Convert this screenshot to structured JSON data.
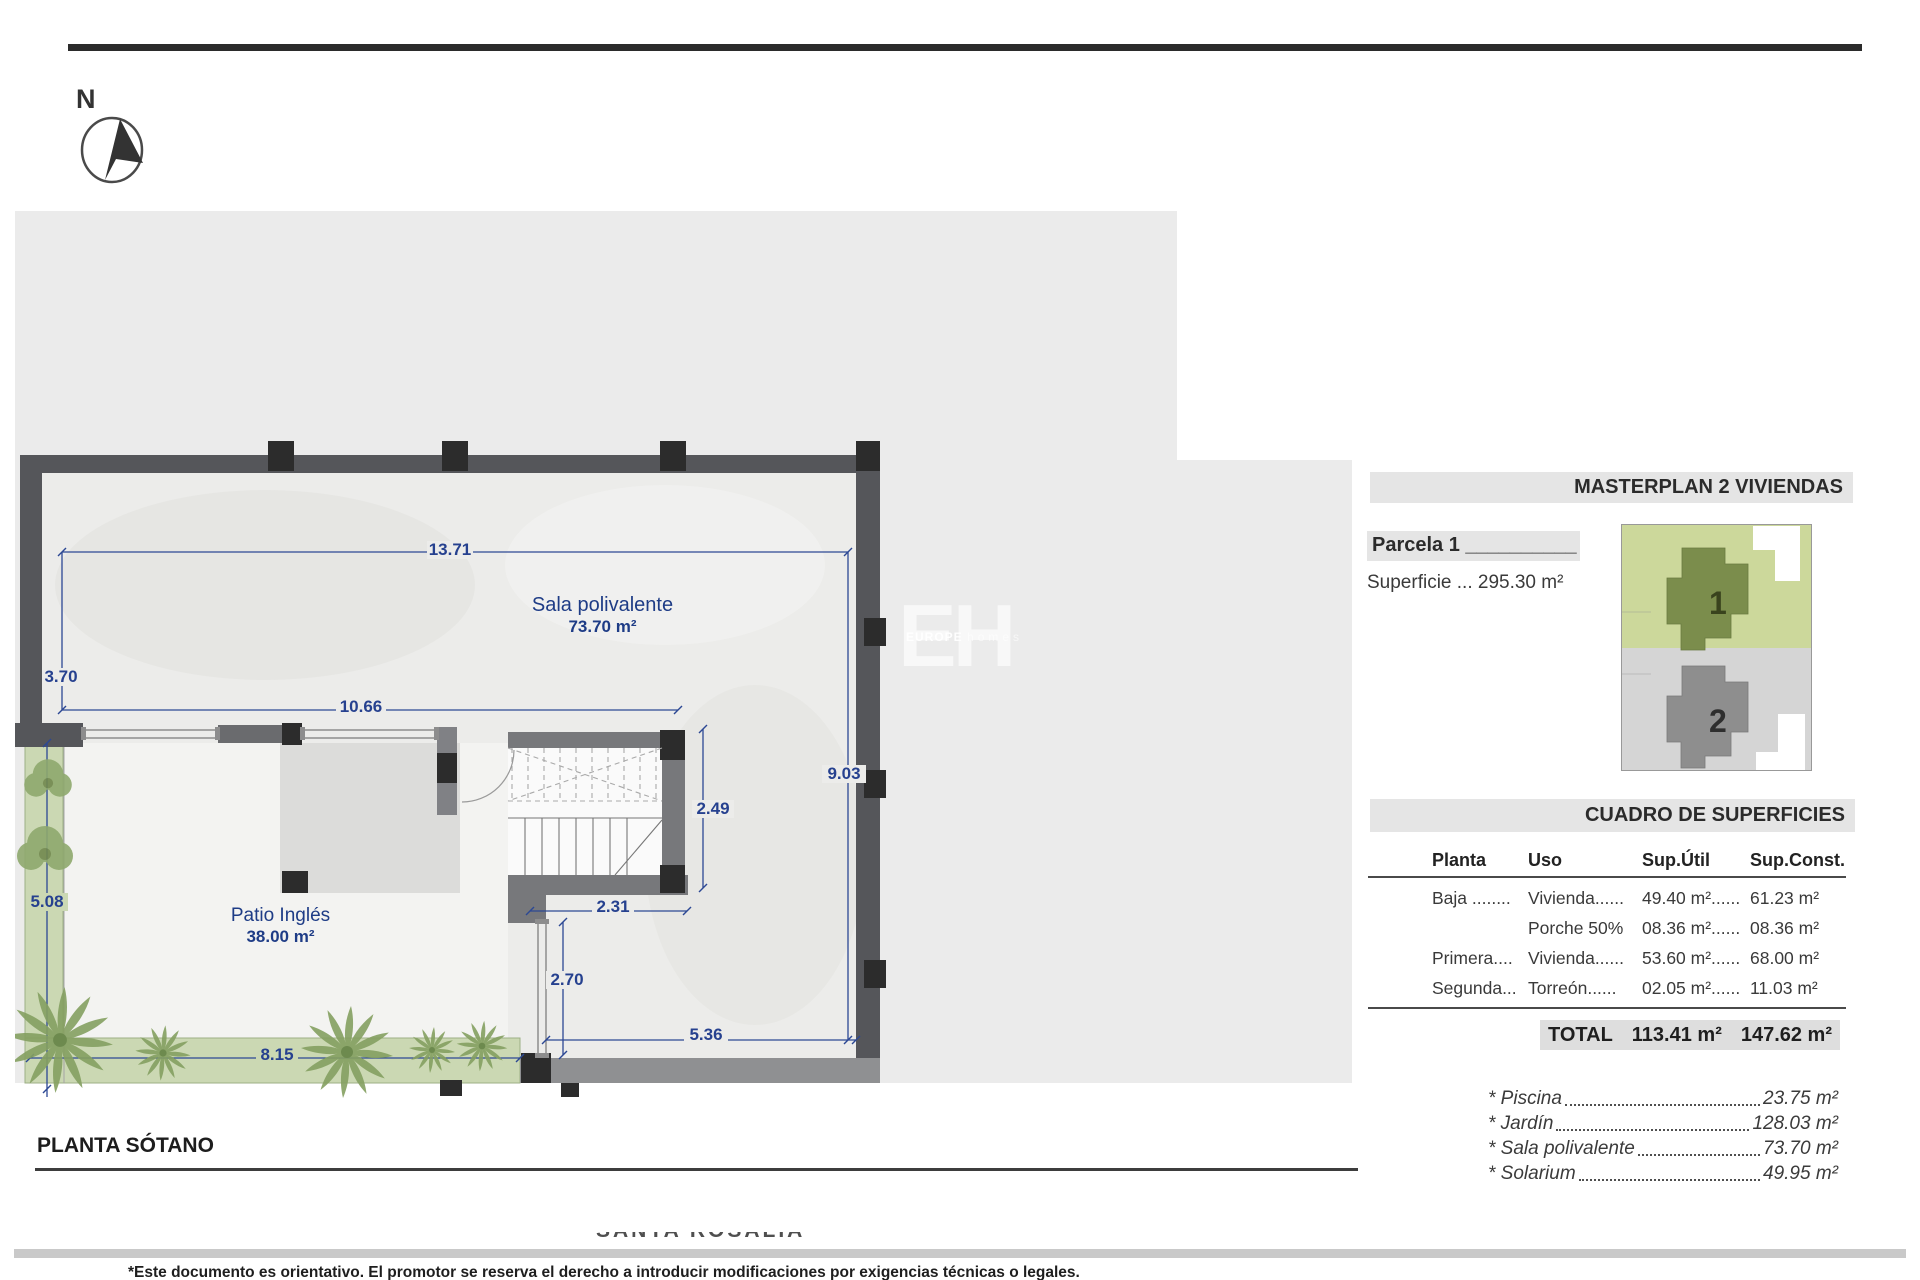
{
  "page": {
    "compass": "N",
    "plan_title": "PLANTA SÓTANO",
    "watermark_big": "EH",
    "watermark_small_bold": "EUROPE",
    "watermark_small_light": "homes",
    "watermark_clipped": "SANTA ROSALIA",
    "footer_note": "*Este documento es orientativo. El promotor se reserva el derecho a introducir modificaciones por exigencias técnicas o legales."
  },
  "plan": {
    "rooms": {
      "sala_title": "Sala polivalente",
      "sala_area": "73.70 m²",
      "patio_title": "Patio Inglés",
      "patio_area": "38.00 m²"
    },
    "dimensions": {
      "top": "13.71",
      "left": "3.70",
      "inner": "10.66",
      "right": "9.03",
      "stair_h": "2.49",
      "stair_w": "2.31",
      "door": "2.70",
      "bottom_right": "5.36",
      "bottom_left": "8.15",
      "left_lower": "5.08"
    }
  },
  "masterplan": {
    "title": "MASTERPLAN 2 VIVIENDAS",
    "parcel": "Parcela 1 __________",
    "superficie": "Superficie ... 295.30 m²",
    "plot1": "1",
    "plot2": "2"
  },
  "table": {
    "title": "CUADRO DE SUPERFICIES",
    "headers": [
      "Planta",
      "Uso",
      "Sup.Útil",
      "Sup.Const."
    ],
    "rows": [
      [
        "Baja ........",
        "Vivienda......",
        "49.40 m²......",
        "61.23 m²"
      ],
      [
        "",
        "Porche 50%",
        "08.36 m²......",
        "08.36 m²"
      ],
      [
        "Primera....",
        "Vivienda......",
        "53.60 m²......",
        "68.00 m²"
      ],
      [
        "Segunda...",
        "Torreón......",
        "02.05 m²......",
        "11.03 m²"
      ]
    ],
    "total_label": "TOTAL",
    "total_util": "113.41 m²",
    "total_const": "147.62 m²"
  },
  "extras": [
    {
      "name": "* Piscina",
      "value": "23.75 m²"
    },
    {
      "name": "* Jardín",
      "value": "128.03 m²"
    },
    {
      "name": "* Sala polivalente",
      "value": "73.70 m²"
    },
    {
      "name": "* Solarium",
      "value": "49.95 m²"
    }
  ],
  "colors": {
    "dimension_blue": "#26418f",
    "wall_gray": "#55565a",
    "backdrop_gray": "#ebebeb",
    "garden_green": "#cbd8b3",
    "plot1_bg": "#ccd89b",
    "plot1_house": "#7b8d4c",
    "plot2_bg": "#d5d5d5",
    "plot2_house": "#8e8e8e"
  }
}
